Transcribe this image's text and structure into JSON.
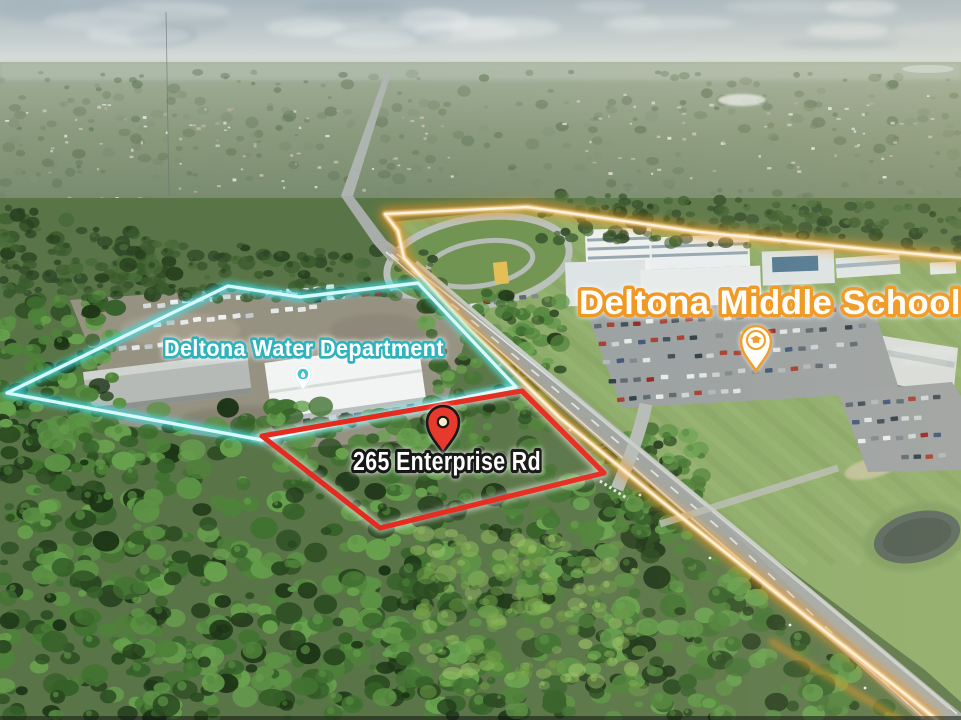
{
  "scene": {
    "type": "aerial-drone-photo",
    "description": "Aerial photo of a wooded vacant parcel outlined in red beside the Deltona Water Department (cyan outline) and Deltona Middle School campus (orange glow outline) along a diagonal divided road"
  },
  "annotations": {
    "school_label": {
      "text": "Deltona Middle School",
      "text_color": "#ffffff",
      "outline_color": "#ee951c"
    },
    "water_label": {
      "text": "Deltona Water Department",
      "text_color": "#ffffff",
      "outline_color": "#2fb3bd"
    },
    "parcel_label": {
      "text": "265 Enterprise Rd",
      "text_color": "#ffffff",
      "outline_color": "#181818"
    },
    "school_pin": {
      "icon": "graduation-cap-pin-icon",
      "color": "#ee951c"
    },
    "water_pin": {
      "icon": "water-drop-pin-icon",
      "color": "#41c4d4"
    },
    "parcel_pin": {
      "icon": "location-pin-icon",
      "color": "#e8392b"
    },
    "school_boundary_color": "#f0941f",
    "water_boundary_color": "#3fdde6",
    "parcel_boundary_color": "#e52b20"
  }
}
